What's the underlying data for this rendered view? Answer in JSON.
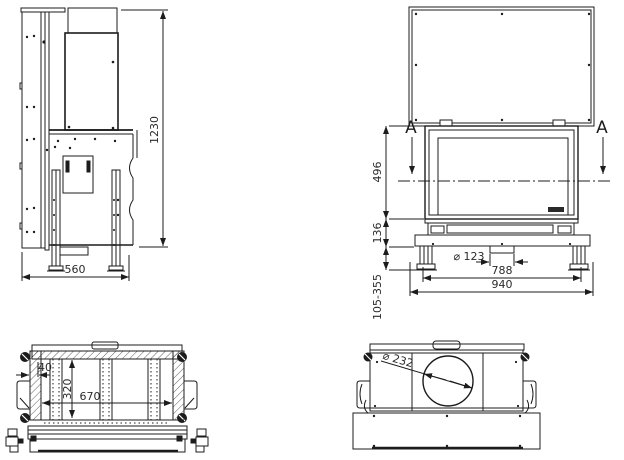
{
  "drawing": {
    "background": "#ffffff",
    "line_color": "#1c1c1c",
    "views": {
      "side": {
        "label": "side-view",
        "dims": {
          "overall_height": "1230",
          "overall_depth": "560"
        }
      },
      "front": {
        "label": "front-view",
        "section_marker_left": "A",
        "section_marker_right": "A",
        "dims": {
          "opening_height": "496",
          "base_height": "136",
          "leg_height_range": "105-355",
          "intake_diameter": "⌀ 123",
          "inner_width": "788",
          "overall_width": "940"
        }
      },
      "section_aa": {
        "label": "section-view",
        "dims": {
          "wall_thickness": "40",
          "inner_depth": "320",
          "inner_width": "670"
        }
      },
      "top": {
        "label": "top-view",
        "dims": {
          "flue_diameter": "⌀ 232"
        }
      }
    }
  }
}
